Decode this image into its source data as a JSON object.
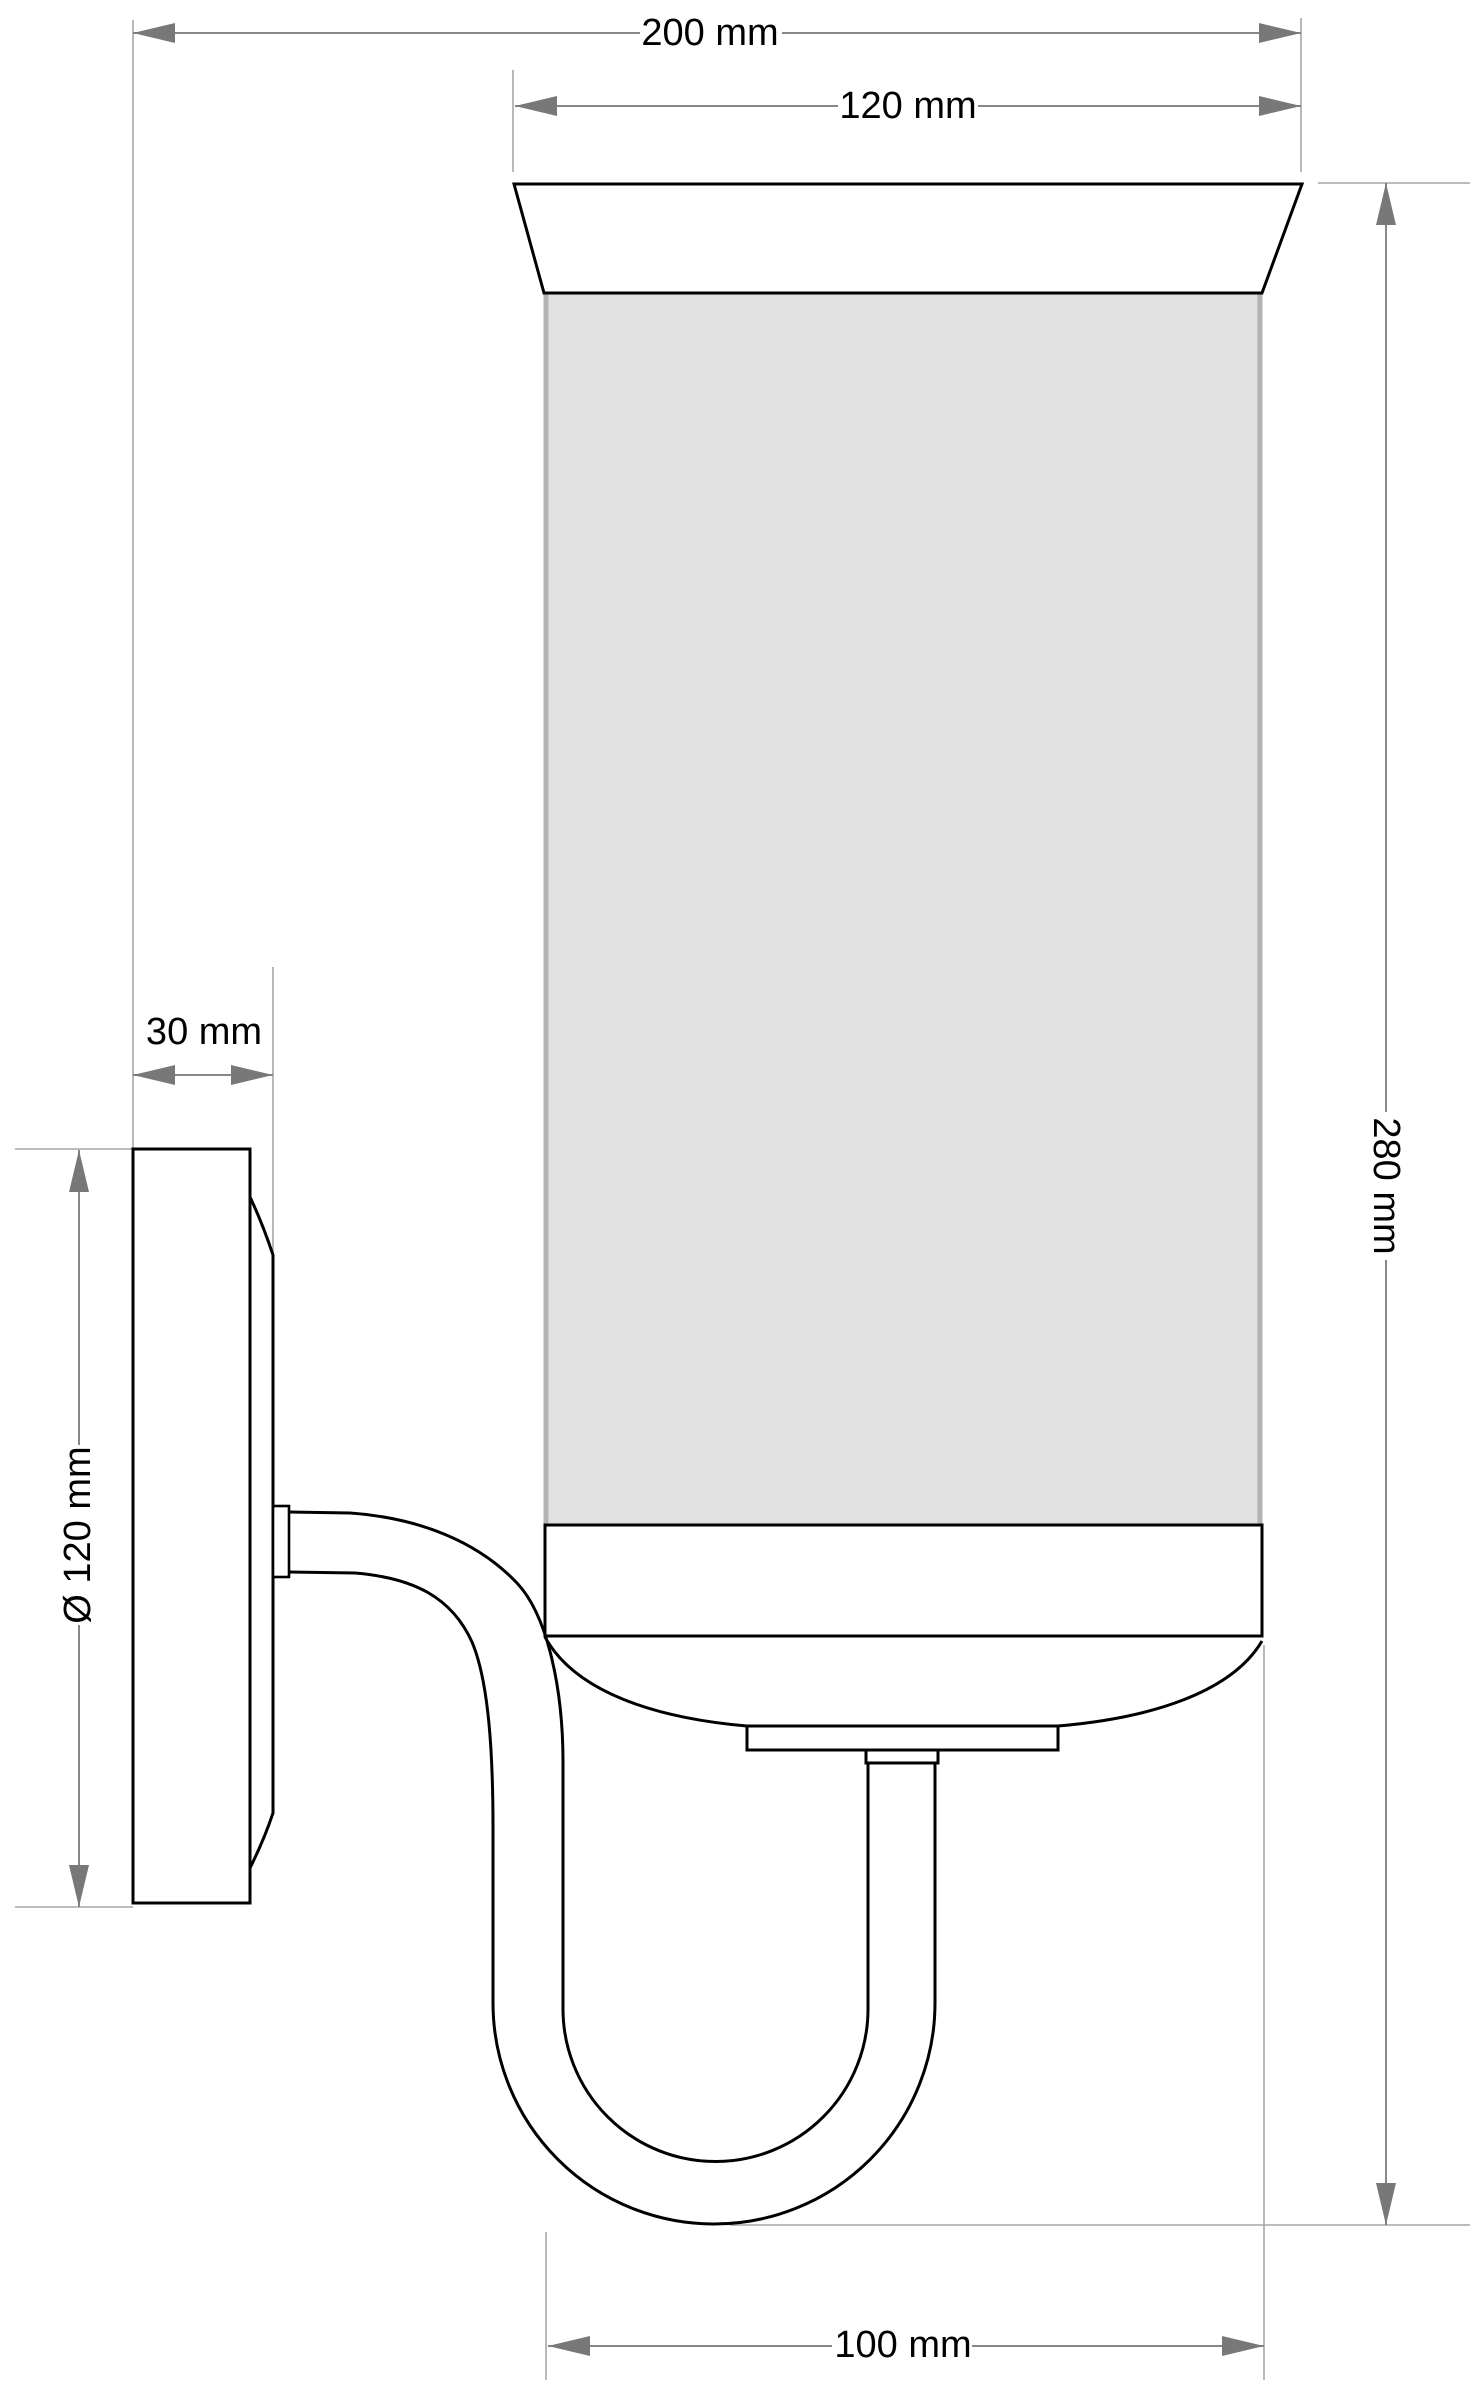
{
  "drawing": {
    "type": "technical-dimension-drawing",
    "subject": "wall-sconce-side-elevation",
    "units": "mm",
    "dimensions": {
      "overall_projection": {
        "label": "200 mm",
        "value": 200
      },
      "shade_top_width": {
        "label": "120 mm",
        "value": 120
      },
      "backplate_depth": {
        "label": "30 mm",
        "value": 30
      },
      "backplate_diameter": {
        "label": "Ø 120 mm",
        "value": 120
      },
      "overall_height": {
        "label": "280 mm",
        "value": 280
      },
      "body_diameter": {
        "label": "100 mm",
        "value": 100
      }
    },
    "colors": {
      "background": "#ffffff",
      "outline": "#000000",
      "glass_fill": "#e1e1e1",
      "glass_edge": "#b3b3b3",
      "dimension_line": "#878787",
      "extension_line": "#a6a6a6",
      "arrowhead": "#787878",
      "text": "#000000"
    }
  }
}
